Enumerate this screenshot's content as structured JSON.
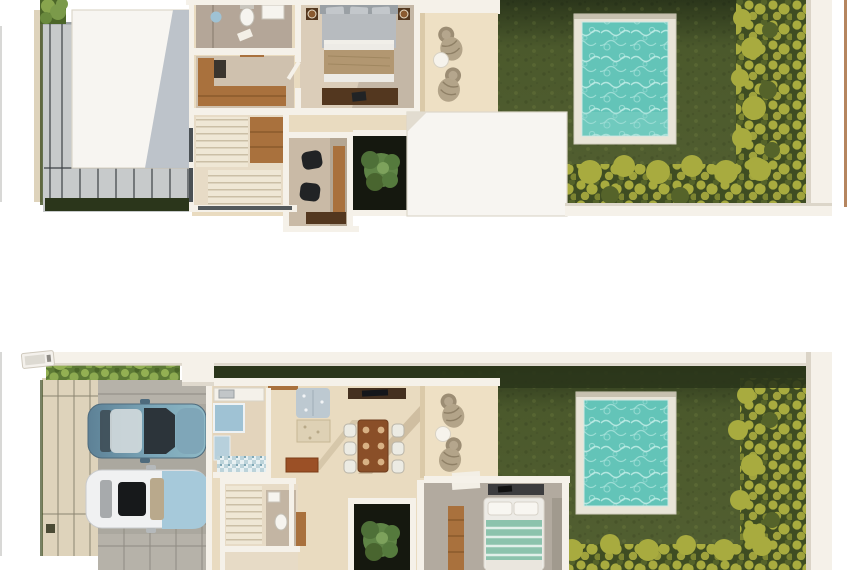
{
  "page": {
    "title": "Two-storey villa floor plans (3D top view render)",
    "background": "#ffffff"
  },
  "palette": {
    "bg": "#ffffff",
    "wall": "#f5f1e9",
    "wall-shade": "#d6cfc1",
    "roof": "#f7f5f1",
    "roof-edge": "#ddd7ca",
    "roof-shadow": "#b9c0c7",
    "deck": "#c7cacb",
    "deck-joint": "#3c4145",
    "floor": "#e9dbc0",
    "terrace": "#eee0c4",
    "paver": "#ded3bb",
    "concrete": "#b6b2a9",
    "grass": "#515f31",
    "grass-dark": "#2b361b",
    "hedge-yellow": "#a8ab3f",
    "hedge-dark": "#3f4d22",
    "hedge-green": "#5d7a35",
    "hedge-light": "#93b053",
    "pool-water": "#63c4b8",
    "pool-ripple": "#c2eee8",
    "pool-frame": "#e9e5d8",
    "wood": "#a9713d",
    "wood-dark": "#53371f",
    "bed-gray": "#b7bbbf",
    "bed-sheet": "#edebe6",
    "bed-throw": "#b29771",
    "bed-teal": "#8cc3ad",
    "car-blue": "#6e95a9",
    "car-blue-light": "#a6c9da",
    "car-white": "#f0f1f2",
    "glass": "#2c343a",
    "tile-blue": "#9fc2d4",
    "wicker": "#b3a489",
    "tree": "#5f8446",
    "courtyard": "#15180f",
    "black": "#212325"
  },
  "scene": {
    "upper_floor": {
      "label": "Upper floor plan",
      "rooms": [
        "bathroom",
        "walk-in closet",
        "master bedroom",
        "staircase",
        "study with two chairs",
        "interior tree patio",
        "sun terrace with loungers",
        "flat roofs",
        "swimming pool",
        "garden with hedges",
        "side timber deck"
      ]
    },
    "ground_floor": {
      "label": "Ground floor plan",
      "rooms": [
        "carport with two cars",
        "paved driveway",
        "kitchen",
        "living room",
        "dining room for six",
        "staircase",
        "guest bathroom",
        "interior tree patio",
        "bedroom",
        "sun terrace with loungers",
        "swimming pool",
        "garden with hedges"
      ]
    },
    "labels": {
      "pool": "swimming pool",
      "garden": "garden lawn",
      "terrace": "sun terrace",
      "deck": "timber deck",
      "driveway": "paved driveway",
      "carport": "carport",
      "blue_car": "blue sedan (top view)",
      "white_car": "white sedan (top view)",
      "bedroom": "bedroom with double bed",
      "bathroom": "bathroom",
      "closet": "walk-in closet",
      "stairs": "staircase",
      "study": "study",
      "tree_patio": "tree patio",
      "kitchen": "kitchen",
      "living": "living room",
      "dining": "dining room",
      "hedge": "hedge",
      "boundary_wall": "white boundary wall"
    },
    "counts": {
      "pools": 2,
      "sun_loungers": 4,
      "cars": 2,
      "dining_seats": 6
    }
  }
}
